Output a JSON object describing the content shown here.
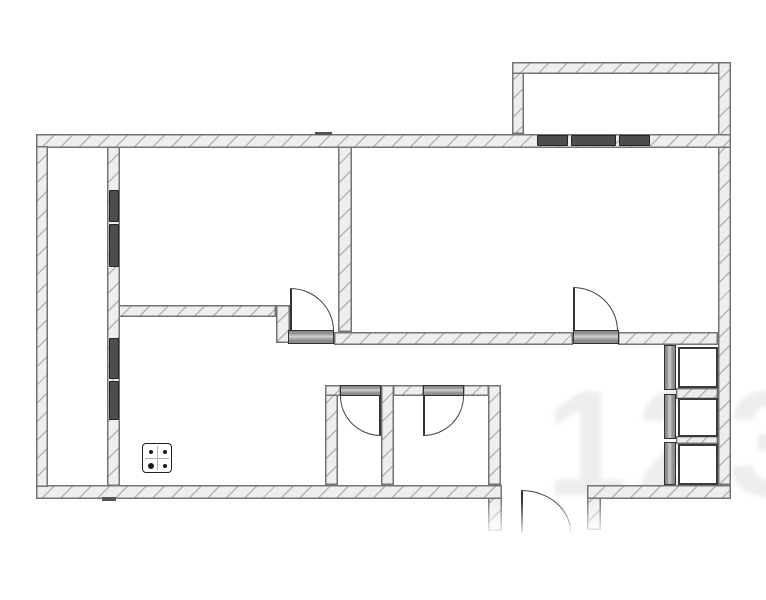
{
  "page": {
    "background": "#ffffff",
    "title": "apartment-floor-plan"
  },
  "plan": {
    "canvas": {
      "width": 766,
      "height": 600
    },
    "colors": {
      "wall_fill": "#eeeeee",
      "hatch_line": "#a9a9a9",
      "wall_edge": "#747474",
      "window_fill": "#4d4d4d",
      "door_bar_fill": "#9a9a9a",
      "door_line": "#414141",
      "closet_box_edge": "#3a3a3a",
      "fixture_edge": "#1f1f1f",
      "watermark_color": "rgba(95,95,95,0.11)"
    },
    "walls": [
      {
        "name": "wall-bedroom-kitchen",
        "x": 113,
        "y": 305,
        "w": 163,
        "h": 12
      },
      {
        "name": "wall-jog-kitchen",
        "x": 276,
        "y": 305,
        "w": 14,
        "h": 38
      },
      {
        "name": "wall-bedroom-living",
        "x": 338,
        "y": 146,
        "w": 14,
        "h": 186
      },
      {
        "name": "wall-hall-top-left",
        "x": 334,
        "y": 332,
        "w": 239,
        "h": 13
      },
      {
        "name": "wall-hall-top-right",
        "x": 618,
        "y": 332,
        "w": 100,
        "h": 13
      },
      {
        "name": "wall-bath-block-left",
        "x": 325,
        "y": 385,
        "w": 13,
        "h": 100
      },
      {
        "name": "wall-bath-top-a",
        "x": 325,
        "y": 385,
        "w": 16,
        "h": 11
      },
      {
        "name": "wall-bath-divider",
        "x": 381,
        "y": 385,
        "w": 13,
        "h": 100
      },
      {
        "name": "wall-bath-top-b",
        "x": 393,
        "y": 385,
        "w": 31,
        "h": 11
      },
      {
        "name": "wall-bath-top-c",
        "x": 463,
        "y": 385,
        "w": 26,
        "h": 11
      },
      {
        "name": "wall-bath-block-right",
        "x": 488,
        "y": 385,
        "w": 13,
        "h": 100
      },
      {
        "name": "wall-vestibule-left",
        "x": 488,
        "y": 485,
        "w": 14,
        "h": 46
      },
      {
        "name": "wall-vestibule-right",
        "x": 587,
        "y": 485,
        "w": 14,
        "h": 45
      },
      {
        "name": "wall-balcony-left",
        "x": 512,
        "y": 62,
        "w": 12,
        "h": 72
      },
      {
        "name": "wall-balcony-top",
        "x": 512,
        "y": 62,
        "w": 219,
        "h": 12
      },
      {
        "name": "wall-right-outer",
        "x": 718,
        "y": 62,
        "w": 13,
        "h": 423
      },
      {
        "name": "wall-loggia-inner",
        "x": 107,
        "y": 146,
        "w": 13,
        "h": 340
      },
      {
        "name": "wall-top-outer",
        "x": 36,
        "y": 134,
        "w": 695,
        "h": 14
      },
      {
        "name": "wall-bottom-left",
        "x": 36,
        "y": 485,
        "w": 466,
        "h": 14
      },
      {
        "name": "wall-bottom-right",
        "x": 587,
        "y": 485,
        "w": 144,
        "h": 14
      },
      {
        "name": "wall-left-outer",
        "x": 36,
        "y": 146,
        "w": 12,
        "h": 341
      }
    ],
    "ticks": [
      {
        "name": "tick-top-wall",
        "x": 315,
        "y": 132,
        "w": 17,
        "h": 3
      },
      {
        "name": "tick-bottom-wall",
        "x": 102,
        "y": 497,
        "w": 14,
        "h": 4
      }
    ],
    "windows": [
      {
        "name": "balcony-window-seg-1",
        "x": 537,
        "y": 135,
        "w": 31,
        "h": 11
      },
      {
        "name": "balcony-window-seg-2",
        "x": 571,
        "y": 135,
        "w": 45,
        "h": 11
      },
      {
        "name": "balcony-window-seg-3",
        "x": 619,
        "y": 135,
        "w": 31,
        "h": 11
      },
      {
        "name": "loggia-window-upper-seg-1",
        "x": 109,
        "y": 190,
        "w": 10,
        "h": 32
      },
      {
        "name": "loggia-window-upper-seg-2",
        "x": 109,
        "y": 224,
        "w": 10,
        "h": 43
      },
      {
        "name": "loggia-window-lower-seg-1",
        "x": 109,
        "y": 338,
        "w": 10,
        "h": 41
      },
      {
        "name": "loggia-window-lower-seg-2",
        "x": 109,
        "y": 381,
        "w": 10,
        "h": 39
      }
    ],
    "door_bars": [
      {
        "name": "bedroom-door-bar",
        "x": 288,
        "y": 330,
        "w": 46,
        "h": 14,
        "orient": "h"
      },
      {
        "name": "living-room-door-bar",
        "x": 573,
        "y": 330,
        "w": 46,
        "h": 14,
        "orient": "h"
      },
      {
        "name": "wc-door-bar",
        "x": 340,
        "y": 385,
        "w": 41,
        "h": 11,
        "orient": "h"
      },
      {
        "name": "bathroom-door-bar",
        "x": 423,
        "y": 385,
        "w": 41,
        "h": 11,
        "orient": "h"
      }
    ],
    "door_swings": [
      {
        "name": "bedroom-door-swing",
        "x": 290,
        "y": 288,
        "w": 44,
        "h": 43,
        "corner": "tr",
        "leaf": "left"
      },
      {
        "name": "living-room-door-swing",
        "x": 573,
        "y": 287,
        "w": 45,
        "h": 44,
        "corner": "tr",
        "leaf": "left"
      },
      {
        "name": "wc-door-swing",
        "x": 340,
        "y": 396,
        "w": 41,
        "h": 40,
        "corner": "bl",
        "leaf": "right"
      },
      {
        "name": "bathroom-door-swing",
        "x": 423,
        "y": 396,
        "w": 41,
        "h": 40,
        "corner": "br",
        "leaf": "left"
      },
      {
        "name": "entry-door-swing",
        "x": 521,
        "y": 490,
        "w": 50,
        "h": 42,
        "corner": "tr",
        "leaf": "left"
      }
    ],
    "closet": {
      "bars": [
        {
          "name": "closet-door-bar-1",
          "x": 664,
          "y": 345,
          "w": 12,
          "h": 45
        },
        {
          "name": "closet-door-bar-2",
          "x": 664,
          "y": 394,
          "w": 12,
          "h": 45
        },
        {
          "name": "closet-door-bar-3",
          "x": 664,
          "y": 442,
          "w": 12,
          "h": 43
        }
      ],
      "shelves": [
        {
          "name": "closet-shelf-1",
          "x": 676,
          "y": 388,
          "w": 42,
          "h": 11
        },
        {
          "name": "closet-shelf-2",
          "x": 676,
          "y": 436,
          "w": 42,
          "h": 8
        }
      ],
      "boxes": [
        {
          "name": "closet-box-1",
          "x": 678,
          "y": 347,
          "w": 40,
          "h": 41
        },
        {
          "name": "closet-box-2",
          "x": 678,
          "y": 398,
          "w": 40,
          "h": 39
        },
        {
          "name": "closet-box-3",
          "x": 678,
          "y": 444,
          "w": 40,
          "h": 41
        }
      ]
    },
    "stove": {
      "name": "stove-symbol",
      "x": 142,
      "y": 443,
      "w": 30,
      "h": 30,
      "burners": [
        {
          "cx": 8,
          "cy": 8,
          "r": 2
        },
        {
          "cx": 22,
          "cy": 8,
          "r": 2
        },
        {
          "cx": 8,
          "cy": 22,
          "r": 3.4
        },
        {
          "cx": 22,
          "cy": 22,
          "r": 2
        }
      ]
    },
    "watermark": {
      "text": "123",
      "x": 545,
      "y": 368,
      "font_size": 150
    },
    "fade": {
      "x": 462,
      "y": 500,
      "w": 170,
      "h": 48
    }
  }
}
